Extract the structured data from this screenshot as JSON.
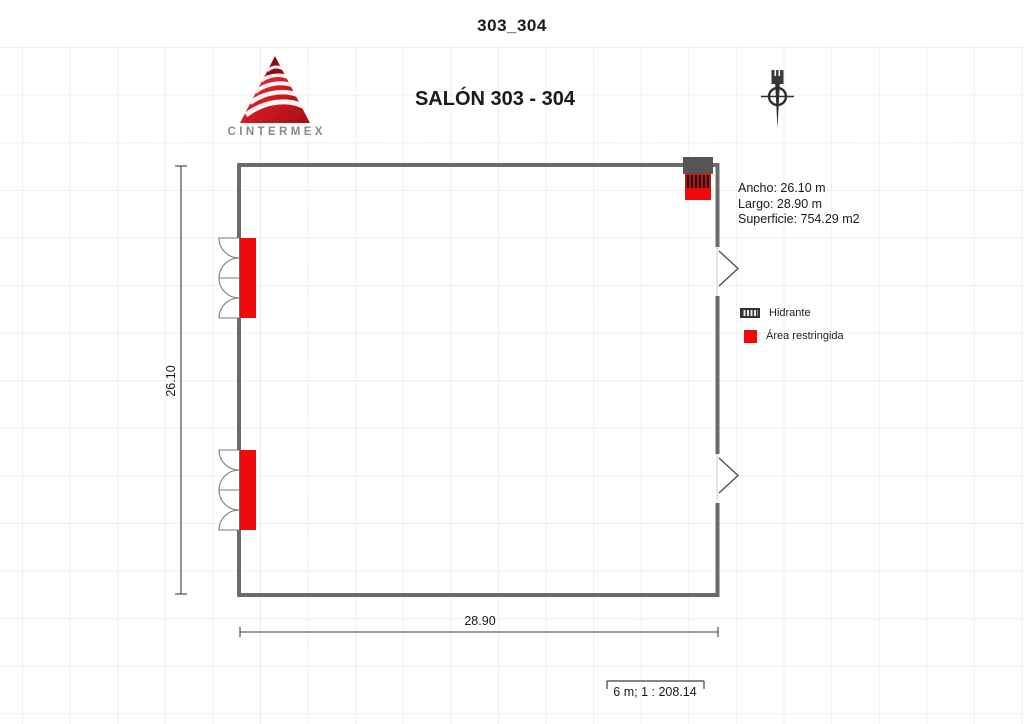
{
  "header": {
    "title": "303_304"
  },
  "logo": {
    "brand": "CINTERMEX"
  },
  "plan": {
    "title": "SALÓN 303 - 304",
    "info": {
      "ancho": "Ancho: 26.10 m",
      "largo": "Largo: 28.90 m",
      "superficie": "Superficie: 754.29 m2"
    },
    "dimensions": {
      "height": "26.10",
      "width": "28.90"
    },
    "scale_label": "6 m; 1 : 208.14"
  },
  "legend": {
    "items": [
      {
        "icon": "hydrant-icon",
        "label": "Hidrante"
      },
      {
        "icon": "restricted-area-icon",
        "label": "Área restringida"
      }
    ]
  },
  "colors": {
    "restricted_red": "#ee0a0a",
    "wall_gray": "#6b6b6b",
    "logo_red": "#c8151b",
    "line_dark": "#3c3c3c"
  }
}
